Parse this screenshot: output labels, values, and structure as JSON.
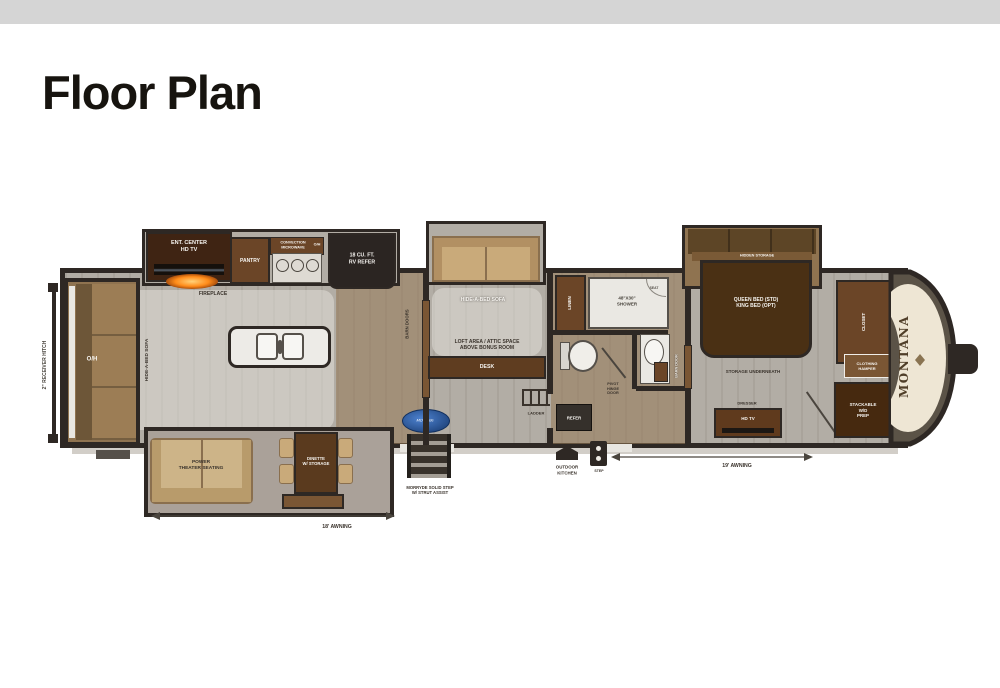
{
  "page": {
    "title": "Floor Plan"
  },
  "plan": {
    "brand": "MONTANA",
    "hitch": "2\" RECEIVER HITCH",
    "awning_left": "18' AWNING",
    "awning_right": "19' AWNING",
    "morryde_logo": "MORryde",
    "steps": "MORRYDE SOLID STEP\nW/ STRUT ASSIST",
    "outdoor_kitchen": "OUTDOOR\nKITCHEN",
    "entry_step": "STEP",
    "living": {
      "overhead": "O/H",
      "rear_sofa": "HIDE-A-BED SOFA",
      "ent_center": "ENT. CENTER\nHD TV",
      "fireplace": "FIREPLACE",
      "theater": "POWER\nTHEATER SEATING",
      "dinette": "DINETTE\nW/ STORAGE"
    },
    "kitchen": {
      "pantry": "PANTRY",
      "range_overhead": "CONVECTION\nMICROWAVE",
      "range_oh": "O/H",
      "refrigerator": "18 CU. FT.\nRV REFER"
    },
    "bonus": {
      "barn_doors": "BARN DOORS",
      "sofa": "HIDE-A-BED SOFA",
      "loft": "LOFT AREA / ATTIC SPACE\nABOVE BONUS ROOM",
      "desk": "DESK",
      "ladder": "LADDER"
    },
    "bath": {
      "linen": "LINEN",
      "shower": "48\"X30\"\nSHOWER",
      "seat": "SEAT",
      "pivot_door": "PIVOT\nHINGE\nDOOR",
      "barn_door": "BARN DOOR",
      "refer": "REFER"
    },
    "bedroom": {
      "hidden_storage": "HIDDEN STORAGE",
      "bed": "QUEEN BED (STD)\nKING BED (OPT)",
      "storage": "STORAGE UNDERNEATH",
      "dresser": "DRESSER",
      "tv": "HD TV",
      "closet": "CLOSET",
      "hamper": "CLOTHING\nHAMPER",
      "wd_prep": "STACKABLE\nW/D\nPREP"
    }
  }
}
